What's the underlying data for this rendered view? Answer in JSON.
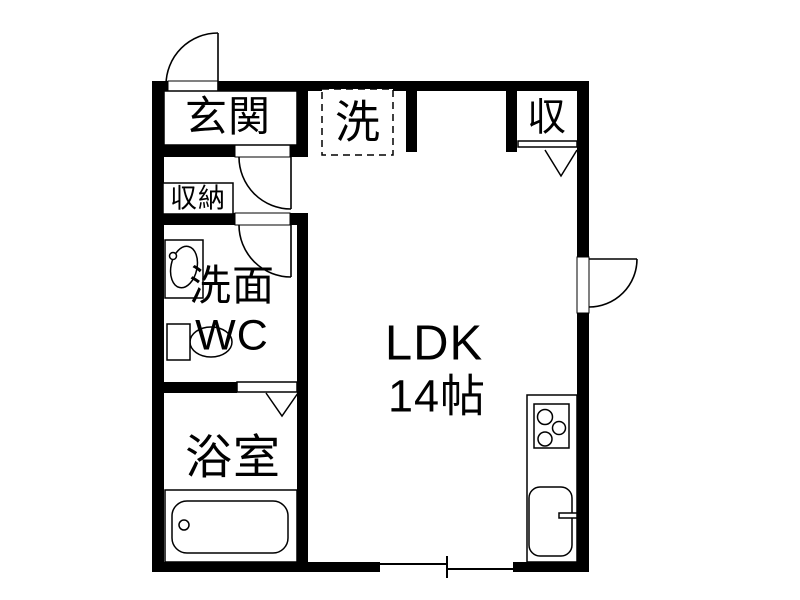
{
  "floorplan": {
    "colors": {
      "wall": "#000000",
      "line": "#000000",
      "background": "#ffffff"
    },
    "labels": {
      "genkan": "玄関",
      "laundry": "洗",
      "storage_upper": "収",
      "storage_hall": "収納",
      "washroom_line1": "洗面",
      "washroom_line2": "WC",
      "ldk_line1": "LDK",
      "ldk_line2": "14帖",
      "bathroom": "浴室"
    },
    "icons": [
      "entry-door-swing-icon",
      "hall-door-swing-icon",
      "washroom-door-swing-icon",
      "ldk-door-swing-icon",
      "closet-folding-door-icon",
      "bath-folding-door-icon",
      "sliding-window-icon",
      "washbasin-icon",
      "toilet-icon",
      "bathtub-icon",
      "stove-icon",
      "kitchen-sink-icon",
      "laundry-space-icon"
    ]
  }
}
